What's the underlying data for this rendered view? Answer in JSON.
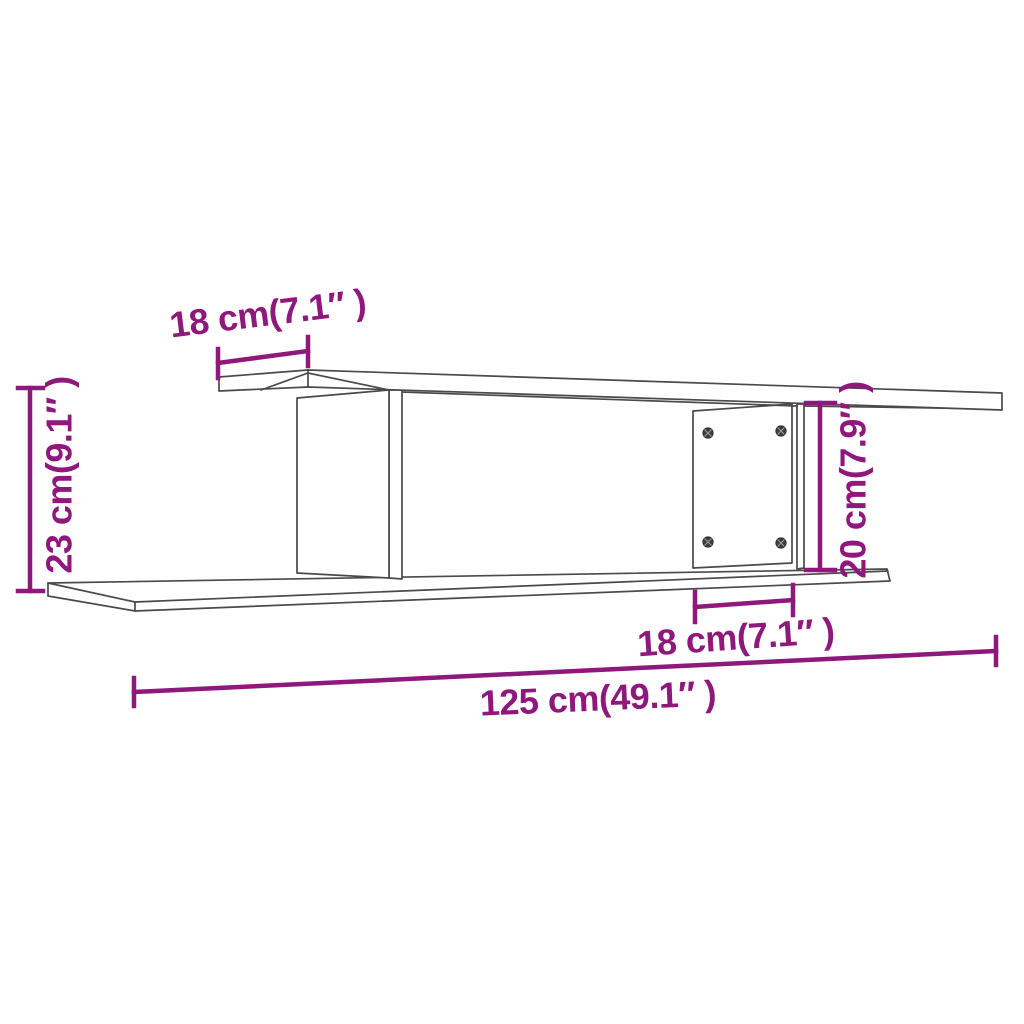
{
  "colors": {
    "accent": "#8E187C",
    "outline": "#4A4A4A",
    "background": "#FFFFFF"
  },
  "dimensions": {
    "top_depth": {
      "label": "18 cm(7.1″ )"
    },
    "left_height": {
      "label": "23 cm(9.1″ )"
    },
    "right_height": {
      "label": "20 cm(7.9″ )"
    },
    "bottom_depth": {
      "label": "18 cm(7.1″ )"
    },
    "total_width": {
      "label": "125 cm(49.1″ )"
    }
  }
}
